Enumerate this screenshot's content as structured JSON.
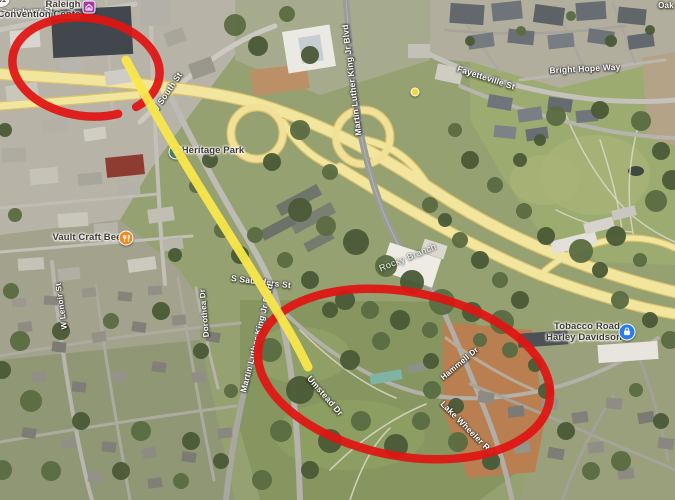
{
  "map": {
    "road_labels": {
      "s_salisbury": "S Salisbury St",
      "w_south": "W South St",
      "mlk_north": "Martin Luther King Jr Blvd",
      "mlk_south": "Martin Luther King Jr Blvd",
      "s_saunders": "S Saunders St",
      "dorothea": "Dorothea Dr",
      "w_lenoir": "W Lenoir St",
      "fayetteville": "Fayetteville St",
      "bright_hope": "Bright Hope Way",
      "umstead": "Umstead Dr",
      "hammell": "Hammell Dr",
      "lake_wheeler": "Lake Wheeler Rd",
      "rocky_branch": "Rocky Branch",
      "oak_partial": "Oak"
    },
    "route_shield": "401",
    "pois": {
      "convention_line1": "Raleigh",
      "convention_line2": "Convention Cente",
      "heritage": "Heritage Park",
      "vault": "Vault Craft Bee",
      "harley_line1": "Tobacco Road",
      "harley_line2": "Harley Davidson"
    },
    "markers": {
      "convention_color": "#a23ba5",
      "heritage_color": "#47796d",
      "vault_color": "#ef8b21",
      "harley_color": "#2b7de9",
      "dot_color": "#f3d844"
    }
  },
  "annotations": {
    "circle_color": "#e01412",
    "route_color": "#f8e74b"
  }
}
